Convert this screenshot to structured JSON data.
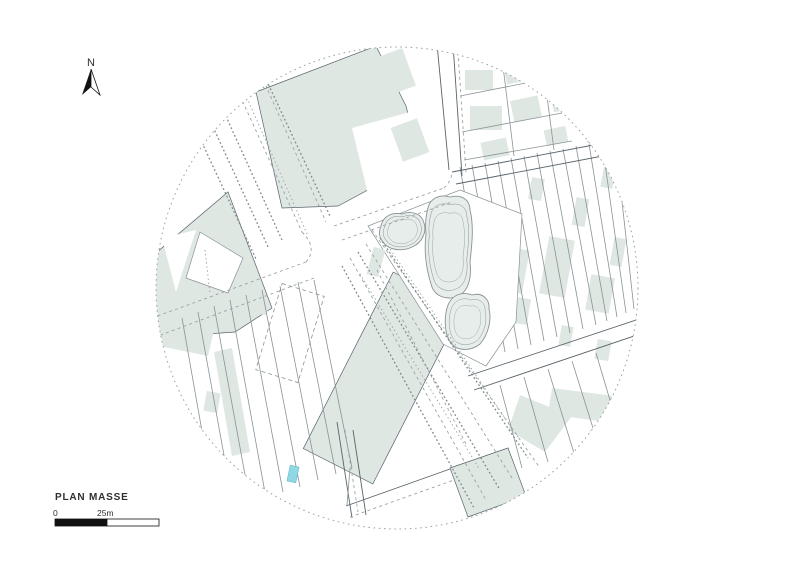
{
  "title_block": {
    "drawing_title": "PLAN MASSE"
  },
  "north_arrow": {
    "label": "N",
    "icon": "north-arrow-icon"
  },
  "scale_bar": {
    "zero_label": "0",
    "mid_label": "25m"
  },
  "colors": {
    "bg": "#ffffff",
    "block-fill": "#dfe7e3",
    "blob-fill": "#e7edea",
    "line": "#8a9296",
    "line-dark": "#59646b",
    "road": "#9aa2a4",
    "tree": "#7f8a89",
    "circle": "#9aa49f",
    "pool": "#8ed9e4",
    "text": "#2e2e2e"
  }
}
